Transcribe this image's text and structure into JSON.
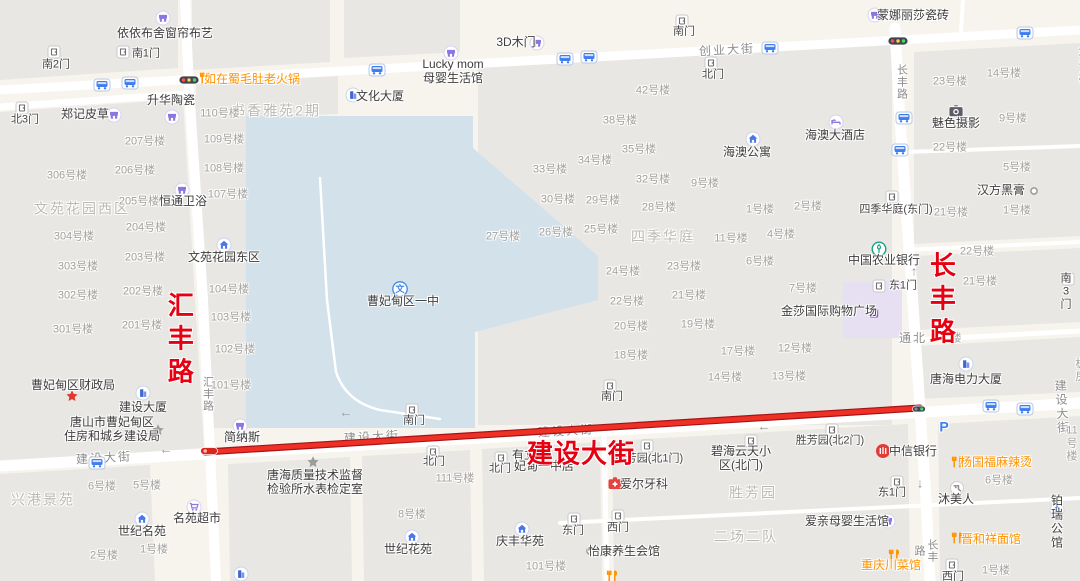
{
  "map": {
    "highlighted_route": {
      "name": "建设大街",
      "color": "#ee3124"
    },
    "colors": {
      "background": "#f7f4ee",
      "block": "#e9e7e3",
      "campus": "#d2e1ea",
      "mall": "#e7e0f2",
      "road": "#ffffff",
      "route_red": "#ee3124",
      "red_label": "#e60012",
      "orange_poi": "#ff9300"
    },
    "labels": [
      {
        "k": "redv",
        "n": "road-label-huifeng-red",
        "t": "汇丰路",
        "x": 178,
        "y": 341
      },
      {
        "k": "redv",
        "n": "road-label-changfeng-red",
        "t": "长丰路",
        "x": 940,
        "y": 301
      },
      {
        "k": "red",
        "n": "road-label-jianshe-red",
        "t": "建设大街",
        "x": 581,
        "y": 455
      },
      {
        "k": "road",
        "t": "创业大街",
        "x": 727,
        "y": 50,
        "r": -3
      },
      {
        "k": "road",
        "t": "建设大街",
        "x": 104,
        "y": 458,
        "r": -3.3
      },
      {
        "k": "road",
        "t": "建设大街",
        "x": 372,
        "y": 437,
        "r": -3.3
      },
      {
        "k": "road",
        "t": "建设大街",
        "x": 566,
        "y": 431,
        "r": -3.3
      },
      {
        "k": "road",
        "t": "建设大街",
        "x": 1063,
        "y": 407,
        "r": -3.3
      },
      {
        "k": "roadv",
        "t": "汇丰路",
        "x": 207,
        "y": 394
      },
      {
        "k": "roadv",
        "t": "长丰路",
        "x": 901,
        "y": 82
      },
      {
        "k": "roadv",
        "t": "长丰路",
        "x": 925,
        "y": 551
      },
      {
        "k": "road",
        "t": "通北",
        "x": 913,
        "y": 338
      },
      {
        "k": "bnum",
        "t": "楼",
        "x": 956,
        "y": 339
      },
      {
        "k": "area",
        "t": "文苑花园西区",
        "x": 82,
        "y": 209
      },
      {
        "k": "area",
        "t": "书香雅苑2期",
        "x": 276,
        "y": 111
      },
      {
        "k": "area",
        "t": "四季华庭",
        "x": 663,
        "y": 237
      },
      {
        "k": "area",
        "t": "兴港景苑",
        "x": 43,
        "y": 500
      },
      {
        "k": "area",
        "t": "胜芳园",
        "x": 753,
        "y": 493
      },
      {
        "k": "area",
        "t": "二场二队",
        "x": 746,
        "y": 537
      },
      {
        "k": "bnum",
        "t": "207号楼",
        "x": 145,
        "y": 142
      },
      {
        "k": "bnum",
        "t": "306号楼",
        "x": 67,
        "y": 176
      },
      {
        "k": "bnum",
        "t": "206号楼",
        "x": 135,
        "y": 171
      },
      {
        "k": "bnum",
        "t": "205号楼",
        "x": 139,
        "y": 202
      },
      {
        "k": "bnum",
        "t": "204号楼",
        "x": 146,
        "y": 228
      },
      {
        "k": "bnum",
        "t": "304号楼",
        "x": 74,
        "y": 237
      },
      {
        "k": "bnum",
        "t": "303号楼",
        "x": 78,
        "y": 267
      },
      {
        "k": "bnum",
        "t": "203号楼",
        "x": 145,
        "y": 258
      },
      {
        "k": "bnum",
        "t": "202号楼",
        "x": 143,
        "y": 292
      },
      {
        "k": "bnum",
        "t": "302号楼",
        "x": 78,
        "y": 296
      },
      {
        "k": "bnum",
        "t": "301号楼",
        "x": 73,
        "y": 330
      },
      {
        "k": "bnum",
        "t": "201号楼",
        "x": 142,
        "y": 326
      },
      {
        "k": "bnum",
        "t": "110号楼",
        "x": 220,
        "y": 114
      },
      {
        "k": "bnum",
        "t": "109号楼",
        "x": 224,
        "y": 140
      },
      {
        "k": "bnum",
        "t": "108号楼",
        "x": 224,
        "y": 169
      },
      {
        "k": "bnum",
        "t": "107号楼",
        "x": 228,
        "y": 195
      },
      {
        "k": "bnum",
        "t": "104号楼",
        "x": 229,
        "y": 290
      },
      {
        "k": "bnum",
        "t": "103号楼",
        "x": 231,
        "y": 318
      },
      {
        "k": "bnum",
        "t": "102号楼",
        "x": 235,
        "y": 350
      },
      {
        "k": "bnum",
        "t": "101号楼",
        "x": 231,
        "y": 386
      },
      {
        "k": "bnum",
        "t": "42号楼",
        "x": 653,
        "y": 91
      },
      {
        "k": "bnum",
        "t": "38号楼",
        "x": 620,
        "y": 121
      },
      {
        "k": "bnum",
        "t": "35号楼",
        "x": 639,
        "y": 150
      },
      {
        "k": "bnum",
        "t": "34号楼",
        "x": 595,
        "y": 161
      },
      {
        "k": "bnum",
        "t": "33号楼",
        "x": 550,
        "y": 170
      },
      {
        "k": "bnum",
        "t": "32号楼",
        "x": 653,
        "y": 180
      },
      {
        "k": "bnum",
        "t": "9号楼",
        "x": 705,
        "y": 184
      },
      {
        "k": "bnum",
        "t": "30号楼",
        "x": 558,
        "y": 200
      },
      {
        "k": "bnum",
        "t": "29号楼",
        "x": 603,
        "y": 201
      },
      {
        "k": "bnum",
        "t": "28号楼",
        "x": 659,
        "y": 208
      },
      {
        "k": "bnum",
        "t": "27号楼",
        "x": 503,
        "y": 237
      },
      {
        "k": "bnum",
        "t": "26号楼",
        "x": 556,
        "y": 233
      },
      {
        "k": "bnum",
        "t": "25号楼",
        "x": 601,
        "y": 230
      },
      {
        "k": "bnum",
        "t": "11号楼",
        "x": 731,
        "y": 239
      },
      {
        "k": "bnum",
        "t": "1号楼",
        "x": 760,
        "y": 210
      },
      {
        "k": "bnum",
        "t": "2号楼",
        "x": 808,
        "y": 207
      },
      {
        "k": "bnum",
        "t": "4号楼",
        "x": 781,
        "y": 235
      },
      {
        "k": "bnum",
        "t": "6号楼",
        "x": 760,
        "y": 262
      },
      {
        "k": "bnum",
        "t": "23号楼",
        "x": 684,
        "y": 267
      },
      {
        "k": "bnum",
        "t": "24号楼",
        "x": 623,
        "y": 272
      },
      {
        "k": "bnum",
        "t": "21号楼",
        "x": 689,
        "y": 296
      },
      {
        "k": "bnum",
        "t": "7号楼",
        "x": 803,
        "y": 289
      },
      {
        "k": "bnum",
        "t": "22号楼",
        "x": 627,
        "y": 302
      },
      {
        "k": "bnum",
        "t": "20号楼",
        "x": 631,
        "y": 327
      },
      {
        "k": "bnum",
        "t": "19号楼",
        "x": 698,
        "y": 325
      },
      {
        "k": "bnum",
        "t": "18号楼",
        "x": 631,
        "y": 356
      },
      {
        "k": "bnum",
        "t": "17号楼",
        "x": 738,
        "y": 352
      },
      {
        "k": "bnum",
        "t": "12号楼",
        "x": 795,
        "y": 349
      },
      {
        "k": "bnum",
        "t": "13号楼",
        "x": 789,
        "y": 377
      },
      {
        "k": "bnum",
        "t": "14号楼",
        "x": 725,
        "y": 378
      },
      {
        "k": "bnum",
        "t": "23号楼",
        "x": 950,
        "y": 82
      },
      {
        "k": "bnum",
        "t": "14号楼",
        "x": 1004,
        "y": 74
      },
      {
        "k": "bnum",
        "t": "15号楼",
        "x": 1084,
        "y": 66
      },
      {
        "k": "bnum",
        "t": "9号楼",
        "x": 1013,
        "y": 119
      },
      {
        "k": "bnum",
        "t": "22号楼",
        "x": 950,
        "y": 148
      },
      {
        "k": "bnum",
        "t": "5号楼",
        "x": 1017,
        "y": 168
      },
      {
        "k": "bnum",
        "t": "1号楼",
        "x": 1017,
        "y": 211
      },
      {
        "k": "bnum",
        "t": "21号楼",
        "x": 951,
        "y": 213
      },
      {
        "k": "bnum",
        "t": "1号楼",
        "x": 1087,
        "y": 108
      },
      {
        "k": "bnum",
        "t": "6号楼",
        "x": 1086,
        "y": 162
      },
      {
        "k": "bnum",
        "t": "22号楼",
        "x": 977,
        "y": 252
      },
      {
        "k": "bnum",
        "t": "21号楼",
        "x": 980,
        "y": 282
      },
      {
        "k": "bnum",
        "t": "板房",
        "x": 1081,
        "y": 371
      },
      {
        "k": "bnum",
        "t": "6号楼",
        "x": 102,
        "y": 487
      },
      {
        "k": "bnum",
        "t": "5号楼",
        "x": 147,
        "y": 486
      },
      {
        "k": "bnum",
        "t": "2号楼",
        "x": 104,
        "y": 556
      },
      {
        "k": "bnum",
        "t": "1号楼",
        "x": 154,
        "y": 550
      },
      {
        "k": "bnum",
        "t": "111号楼",
        "x": 455,
        "y": 479
      },
      {
        "k": "bnum",
        "t": "8号楼",
        "x": 412,
        "y": 515
      },
      {
        "k": "bnum",
        "t": "101号楼",
        "x": 546,
        "y": 567
      },
      {
        "k": "bnum",
        "t": "11号楼",
        "x": 1072,
        "y": 444
      },
      {
        "k": "bnum",
        "t": "6号楼",
        "x": 999,
        "y": 481
      },
      {
        "k": "bnum",
        "t": "1号楼",
        "x": 996,
        "y": 571
      },
      {
        "k": "poi",
        "t": "依依布舍窗帘布艺",
        "x": 165,
        "y": 33,
        "icon": "shop",
        "ix": 163,
        "iy": 18
      },
      {
        "k": "poi",
        "t": "郑记皮草",
        "x": 85,
        "y": 114,
        "icon": "shop",
        "ix": 114,
        "iy": 115
      },
      {
        "k": "poi",
        "t": "升华陶瓷",
        "x": 171,
        "y": 100,
        "icon": "shop",
        "ix": 172,
        "iy": 117
      },
      {
        "k": "orange",
        "t": "如在蜀毛肚老火锅",
        "x": 252,
        "y": 79,
        "icon": "rest",
        "ix": 205,
        "iy": 78
      },
      {
        "k": "poi",
        "t": "文化大厦",
        "x": 380,
        "y": 96,
        "icon": "bldg",
        "ix": 353,
        "iy": 95
      },
      {
        "k": "poi",
        "t": "3D木门",
        "x": 516,
        "y": 42,
        "icon": "shop",
        "ix": 537,
        "iy": 43
      },
      {
        "k": "poi",
        "t": "Lucky mom\n母婴生活馆",
        "x": 453,
        "y": 71,
        "icon": "shop",
        "ix": 451,
        "iy": 53
      },
      {
        "k": "poi",
        "t": "蒙娜丽莎瓷砖",
        "x": 913,
        "y": 15,
        "icon": "shop",
        "ix": 875,
        "iy": 15
      },
      {
        "k": "poi",
        "t": "海澳大酒店",
        "x": 835,
        "y": 135,
        "icon": "bed",
        "ix": 836,
        "iy": 122
      },
      {
        "k": "poi",
        "t": "海澳公寓",
        "x": 747,
        "y": 152,
        "icon": "house",
        "ix": 753,
        "iy": 139
      },
      {
        "k": "poi",
        "t": "魅色摄影",
        "x": 956,
        "y": 123,
        "icon": "camera",
        "ix": 956,
        "iy": 111
      },
      {
        "k": "poi",
        "t": "汉方黑膏",
        "x": 1001,
        "y": 190,
        "icon": "ring",
        "ix": 1034,
        "iy": 191
      },
      {
        "k": "poi",
        "t": "恒通卫浴",
        "x": 183,
        "y": 201,
        "icon": "shop",
        "ix": 182,
        "iy": 190
      },
      {
        "k": "poi",
        "t": "文苑花园东区",
        "x": 224,
        "y": 257,
        "icon": "house",
        "ix": 224,
        "iy": 245
      },
      {
        "k": "poi",
        "t": "曹妃甸区一中",
        "x": 403,
        "y": 301,
        "icon": "school",
        "ix": 400,
        "iy": 289
      },
      {
        "k": "poi",
        "t": "中国农业银行",
        "x": 884,
        "y": 260,
        "icon": "bankg",
        "ix": 879,
        "iy": 249
      },
      {
        "k": "poi",
        "t": "金莎国际购物广场",
        "x": 829,
        "y": 311,
        "icon": "bag",
        "ix": 874,
        "iy": 312
      },
      {
        "k": "poi",
        "t": "唐海电力大厦",
        "x": 966,
        "y": 379,
        "icon": "bldg",
        "ix": 966,
        "iy": 364
      },
      {
        "k": "poi",
        "t": "曹妃甸区财政局",
        "x": 73,
        "y": 385,
        "icon": "starred",
        "ix": 72,
        "iy": 396
      },
      {
        "k": "poi",
        "t": "建设大厦",
        "x": 143,
        "y": 407,
        "icon": "bldg",
        "ix": 143,
        "iy": 393
      },
      {
        "k": "poi",
        "t": "唐山市曹妃甸区\n住房和城乡建设局",
        "x": 112,
        "y": 429,
        "icon": "stargray",
        "ix": 158,
        "iy": 430
      },
      {
        "k": "poi",
        "t": "简纳斯",
        "x": 242,
        "y": 437,
        "icon": "shop",
        "ix": 240,
        "iy": 426
      },
      {
        "k": "poi",
        "t": "唐海质量技术监督\n检验所水表检定室",
        "x": 315,
        "y": 482,
        "icon": "stargray",
        "ix": 313,
        "iy": 462
      },
      {
        "k": "poi",
        "t": "有立",
        "x": 524,
        "y": 455
      },
      {
        "k": "poi",
        "t": "妃甸一中店",
        "x": 544,
        "y": 466
      },
      {
        "k": "poi",
        "t": "爱尔牙科",
        "x": 644,
        "y": 484,
        "icon": "cross",
        "ix": 615,
        "iy": 483
      },
      {
        "k": "poi",
        "t": "中信银行",
        "x": 913,
        "y": 451,
        "icon": "bankr",
        "ix": 883,
        "iy": 451
      },
      {
        "k": "orange",
        "t": "杨国福麻辣烫",
        "x": 996,
        "y": 462,
        "icon": "rest",
        "ix": 957,
        "iy": 462
      },
      {
        "k": "poi",
        "t": "沐美人",
        "x": 956,
        "y": 499,
        "icon": "beauty",
        "ix": 957,
        "iy": 488
      },
      {
        "k": "poi",
        "t": "爱亲母婴生活馆",
        "x": 847,
        "y": 521,
        "icon": "shop",
        "ix": 888,
        "iy": 521
      },
      {
        "k": "poi",
        "t": "铂瑞公馆",
        "x": 1057,
        "y": 522,
        "icon": "house",
        "ix": 1057,
        "iy": 510
      },
      {
        "k": "orange",
        "t": "晋和祥面馆",
        "x": 991,
        "y": 539,
        "icon": "rest",
        "ix": 957,
        "iy": 538
      },
      {
        "k": "orange",
        "t": "重庆川菜馆",
        "x": 891,
        "y": 565,
        "icon": "rest",
        "ix": 894,
        "iy": 555
      },
      {
        "k": "poi",
        "t": "怡康养生会馆",
        "x": 624,
        "y": 551,
        "icon": "ring",
        "ix": 590,
        "iy": 551
      },
      {
        "k": "poi",
        "t": "世纪名苑",
        "x": 142,
        "y": 531,
        "icon": "house",
        "ix": 142,
        "iy": 519
      },
      {
        "k": "poi",
        "t": "名苑超市",
        "x": 197,
        "y": 518,
        "icon": "cart",
        "ix": 194,
        "iy": 507
      },
      {
        "k": "poi",
        "t": "世纪花苑",
        "x": 408,
        "y": 549,
        "icon": "house",
        "ix": 412,
        "iy": 537
      },
      {
        "k": "poi",
        "t": "庆丰华苑",
        "x": 520,
        "y": 541,
        "icon": "house",
        "ix": 522,
        "iy": 529
      },
      {
        "k": "poi",
        "t": "碧海云天小\n区(北门)",
        "x": 741,
        "y": 458,
        "icon": "door",
        "ix": 751,
        "iy": 441
      },
      {
        "k": "gate",
        "t": "胜芳园(北1门)",
        "x": 649,
        "y": 459,
        "icon": "door",
        "ix": 647,
        "iy": 446
      },
      {
        "k": "gate",
        "t": "胜芳园(北2门)",
        "x": 830,
        "y": 441,
        "icon": "door",
        "ix": 832,
        "iy": 430
      },
      {
        "k": "gate",
        "t": "南2门",
        "x": 56,
        "y": 65,
        "icon": "door",
        "ix": 54,
        "iy": 52
      },
      {
        "k": "gate",
        "t": "南1门",
        "x": 146,
        "y": 54,
        "icon": "door",
        "ix": 123,
        "iy": 52
      },
      {
        "k": "gate",
        "t": "北3门",
        "x": 25,
        "y": 120,
        "icon": "door",
        "ix": 22,
        "iy": 108
      },
      {
        "k": "gate",
        "t": "南门",
        "x": 684,
        "y": 32,
        "icon": "door",
        "ix": 682,
        "iy": 21
      },
      {
        "k": "gate",
        "t": "北门",
        "x": 713,
        "y": 75,
        "icon": "door",
        "ix": 711,
        "iy": 63
      },
      {
        "k": "gate",
        "t": "四季华庭(东门)",
        "x": 896,
        "y": 210,
        "icon": "door",
        "ix": 892,
        "iy": 197
      },
      {
        "k": "gate",
        "t": "东1门",
        "x": 903,
        "y": 286,
        "icon": "door",
        "ix": 879,
        "iy": 286
      },
      {
        "k": "gate",
        "t": "南3门",
        "x": 1066,
        "y": 292,
        "icon": "door",
        "ix": 1068,
        "iy": 279
      },
      {
        "k": "gate",
        "t": "南门",
        "x": 414,
        "y": 421,
        "icon": "door",
        "ix": 412,
        "iy": 410
      },
      {
        "k": "gate",
        "t": "南门",
        "x": 612,
        "y": 397,
        "icon": "door",
        "ix": 610,
        "iy": 386
      },
      {
        "k": "gate",
        "t": "北门",
        "x": 434,
        "y": 462,
        "icon": "door",
        "ix": 433,
        "iy": 452
      },
      {
        "k": "gate",
        "t": "北门",
        "x": 500,
        "y": 469,
        "icon": "door",
        "ix": 501,
        "iy": 458
      },
      {
        "k": "gate",
        "t": "东门",
        "x": 573,
        "y": 531,
        "icon": "door",
        "ix": 574,
        "iy": 519
      },
      {
        "k": "gate",
        "t": "西门",
        "x": 618,
        "y": 528,
        "icon": "door",
        "ix": 618,
        "iy": 516
      },
      {
        "k": "gate",
        "t": "东1门",
        "x": 892,
        "y": 493,
        "icon": "door",
        "ix": 897,
        "iy": 482
      },
      {
        "k": "gate",
        "t": "西门",
        "x": 953,
        "y": 577,
        "icon": "door",
        "ix": 952,
        "iy": 565
      },
      {
        "k": "park",
        "t": "P",
        "x": 944,
        "y": 427
      },
      {
        "k": "arrow",
        "t": "←",
        "x": 166,
        "y": 449
      },
      {
        "k": "arrow",
        "t": "←",
        "x": 346,
        "y": 412
      },
      {
        "k": "arrow",
        "t": "←",
        "x": 764,
        "y": 426
      },
      {
        "k": "arrow",
        "t": "↑",
        "x": 914,
        "y": 271
      },
      {
        "k": "arrow",
        "t": "↓",
        "x": 920,
        "y": 483
      },
      {
        "icon": "bus",
        "x": 102,
        "y": 85
      },
      {
        "icon": "bus",
        "x": 130,
        "y": 83
      },
      {
        "icon": "bus",
        "x": 377,
        "y": 70
      },
      {
        "icon": "bus",
        "x": 565,
        "y": 59
      },
      {
        "icon": "bus",
        "x": 589,
        "y": 57
      },
      {
        "icon": "bus",
        "x": 770,
        "y": 48
      },
      {
        "icon": "bus",
        "x": 1025,
        "y": 33
      },
      {
        "icon": "bus",
        "x": 904,
        "y": 118
      },
      {
        "icon": "bus",
        "x": 900,
        "y": 150
      },
      {
        "icon": "bus",
        "x": 97,
        "y": 463
      },
      {
        "icon": "bus",
        "x": 991,
        "y": 406
      },
      {
        "icon": "bus",
        "x": 1025,
        "y": 409
      },
      {
        "icon": "light",
        "x": 189,
        "y": 80
      },
      {
        "icon": "light",
        "x": 898,
        "y": 41
      },
      {
        "icon": "lightsm",
        "x": 919,
        "y": 409,
        "z": 4
      },
      {
        "icon": "rstart",
        "x": 209,
        "y": 451,
        "z": 4
      },
      {
        "icon": "rest",
        "x": 612,
        "y": 576
      },
      {
        "icon": "bldg",
        "x": 241,
        "y": 574
      }
    ]
  }
}
